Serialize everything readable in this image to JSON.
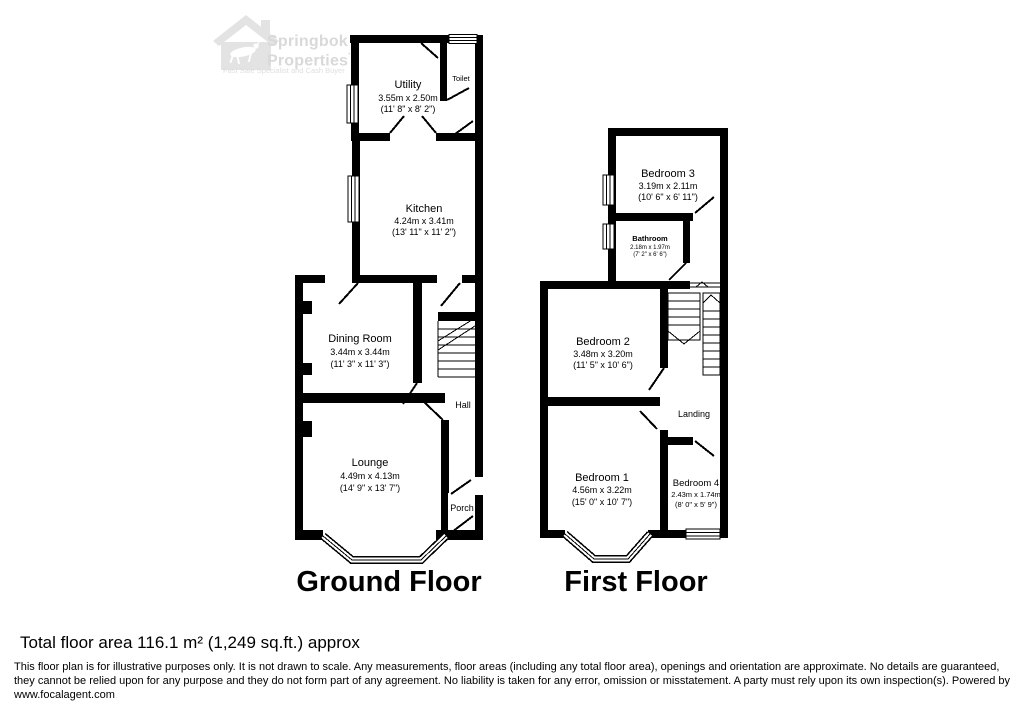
{
  "logo": {
    "brand_line1": "Springbok",
    "brand_line2": "Properties",
    "mark": "'",
    "tagline": "Fast Sale Specialist and Cash Buyer"
  },
  "floors": {
    "ground": {
      "label": "Ground Floor",
      "rooms": {
        "utility": {
          "name": "Utility",
          "metric": "3.55m x 2.50m",
          "imperial": "(11' 8\" x 8' 2\")"
        },
        "toilet": {
          "name": "Toilet"
        },
        "kitchen": {
          "name": "Kitchen",
          "metric": "4.24m x 3.41m",
          "imperial": "(13' 11\" x 11' 2\")"
        },
        "dining": {
          "name": "Dining Room",
          "metric": "3.44m x 3.44m",
          "imperial": "(11' 3\" x 11' 3\")"
        },
        "hall": {
          "name": "Hall"
        },
        "lounge": {
          "name": "Lounge",
          "metric": "4.49m x 4.13m",
          "imperial": "(14' 9\" x 13' 7\")"
        },
        "porch": {
          "name": "Porch"
        }
      }
    },
    "first": {
      "label": "First Floor",
      "rooms": {
        "bedroom3": {
          "name": "Bedroom 3",
          "metric": "3.19m x 2.11m",
          "imperial": "(10' 6\" x 6' 11\")"
        },
        "bathroom": {
          "name": "Bathroom",
          "metric": "2.18m x 1.97m",
          "imperial": "(7' 2\" x 6' 6\")"
        },
        "bedroom2": {
          "name": "Bedroom 2",
          "metric": "3.48m x 3.20m",
          "imperial": "(11' 5\" x 10' 6\")"
        },
        "landing": {
          "name": "Landing"
        },
        "bedroom1": {
          "name": "Bedroom 1",
          "metric": "4.56m x 3.22m",
          "imperial": "(15' 0\" x 10' 7\")"
        },
        "bedroom4": {
          "name": "Bedroom 4",
          "metric": "2.43m x 1.74m",
          "imperial": "(8' 0\" x 5' 9\")"
        }
      }
    }
  },
  "footer": {
    "total_area": "Total floor area 116.1 m² (1,249 sq.ft.) approx",
    "disclaimer": "This floor plan is for illustrative purposes only. It is not drawn to scale. Any measurements, floor areas (including any total floor area), openings and orientation are approximate. No details are guaranteed, they cannot be relied upon for any purpose and they do not form part of any agreement. No liability is taken for any error, omission or misstatement. A party must rely upon its own inspection(s). Powered by www.focalagent.com"
  }
}
